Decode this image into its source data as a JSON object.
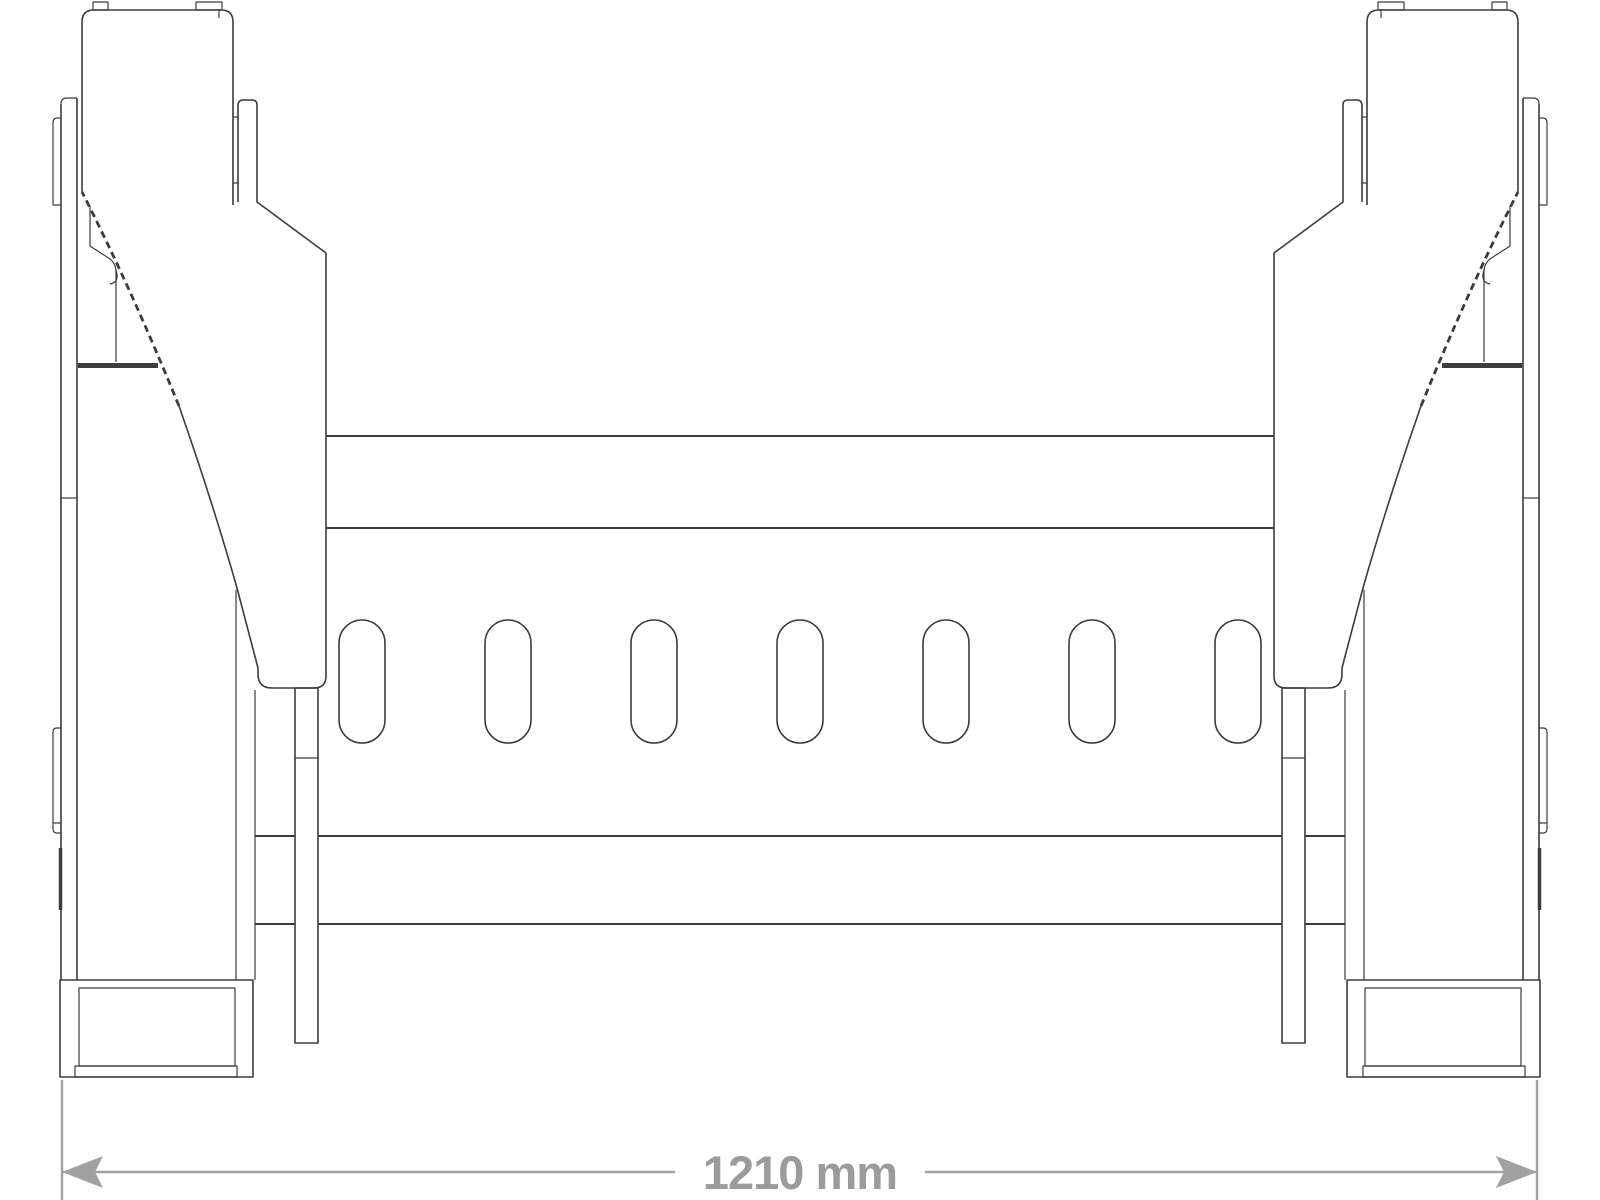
{
  "title": "Front-view technical line drawing of a loader attachment frame with two mounting posts",
  "dimension": {
    "label": "1210 mm",
    "value": 1210,
    "unit": "mm"
  },
  "drawing": {
    "view": "front",
    "slot_count": 7,
    "symmetry": "mirrored about vertical center line",
    "features": [
      "left mounting post",
      "right mounting post",
      "upper crossbar",
      "lower crossbar",
      "row of seven oblong slots",
      "side plates",
      "bottom foot boxes",
      "drop tines",
      "overall width dimension line"
    ]
  },
  "colors": {
    "line-color": "#3c3c3c",
    "dim-color": "#a1a1a1",
    "dim-text-color": "#9b9b9b",
    "bg-color": "#ffffff"
  }
}
